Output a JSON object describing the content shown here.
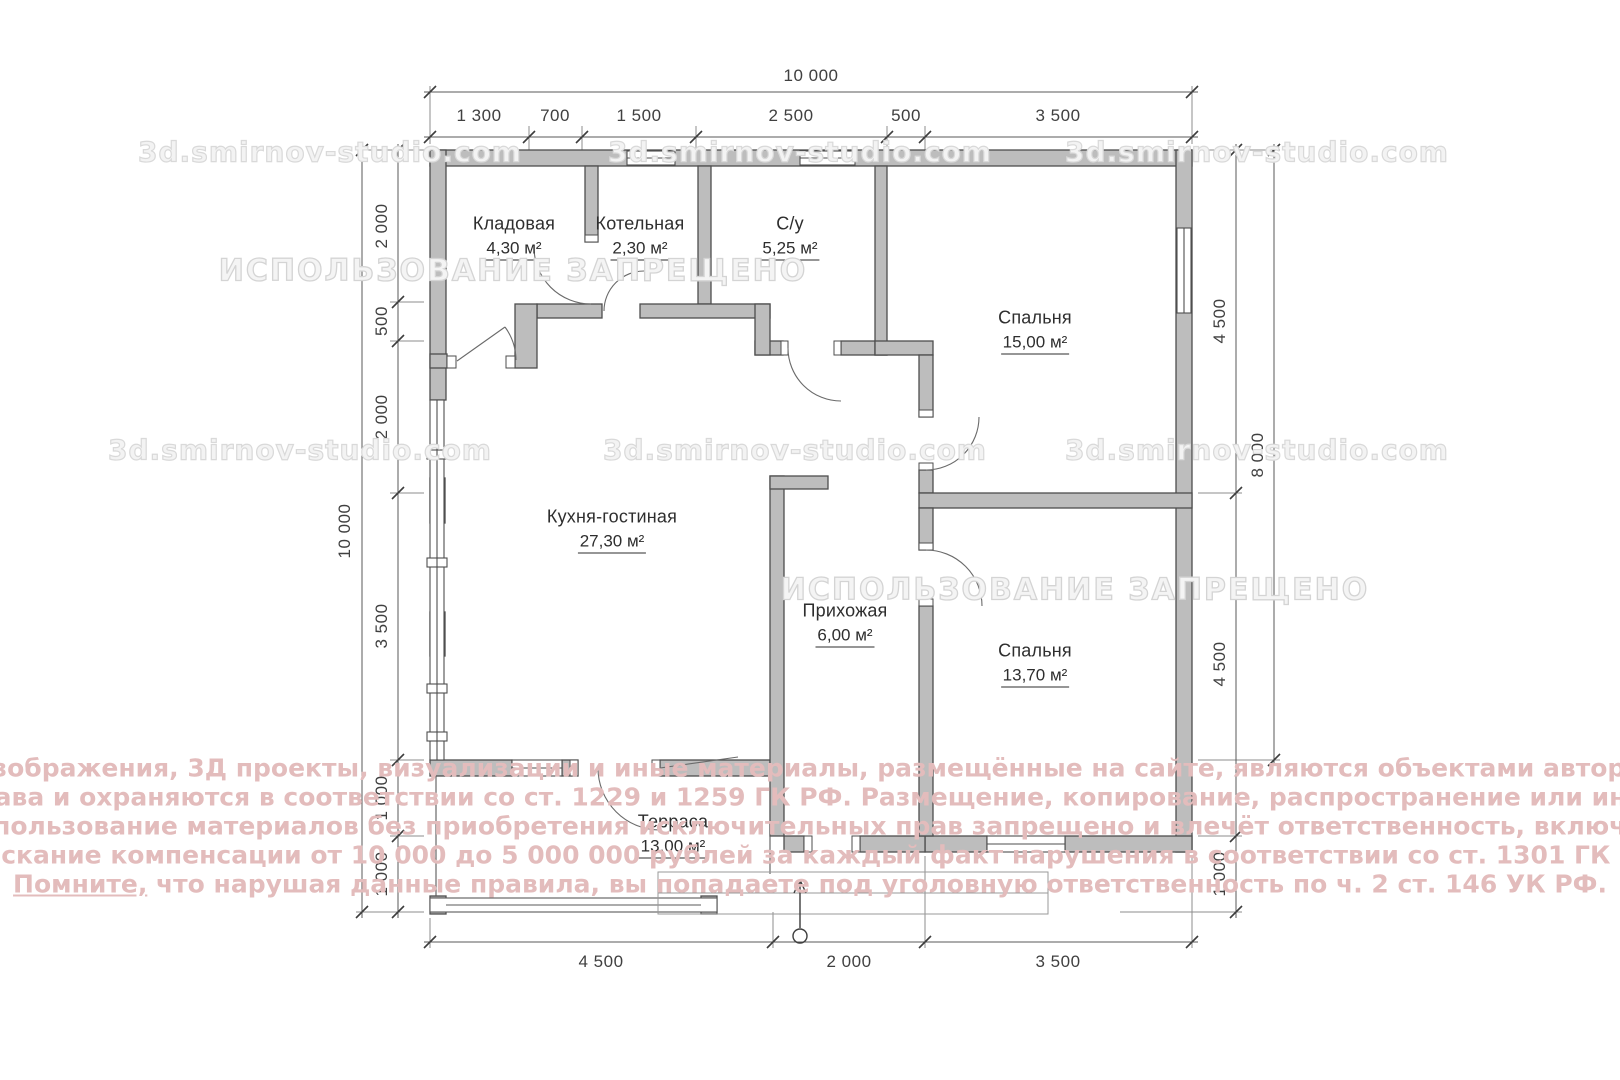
{
  "rooms": [
    {
      "name": "Кладовая",
      "area": "4,30 м²"
    },
    {
      "name": "Котельная",
      "area": "2,30 м²"
    },
    {
      "name": "С/у",
      "area": "5,25 м²"
    },
    {
      "name": "Спальня",
      "area": "15,00 м²"
    },
    {
      "name": "Кухня-гостиная",
      "area": "27,30 м²"
    },
    {
      "name": "Прихожая",
      "area": "6,00 м²"
    },
    {
      "name": "Спальня",
      "area": "13,70 м²"
    },
    {
      "name": "Терраса",
      "area": "13,00 м²"
    }
  ],
  "dimensions": {
    "top_total": "10 000",
    "top_segments": [
      "1 300",
      "700",
      "1 500",
      "2 500",
      "500",
      "3 500"
    ],
    "left_total": "10 000",
    "left_segments": [
      "2 000",
      "500",
      "2 000",
      "3 500",
      "1 000",
      "1 000"
    ],
    "right_total": "8 000",
    "right_segments": [
      "4 500",
      "4 500",
      "1 000"
    ],
    "bottom_segments": [
      "4 500",
      "2 000",
      "3 500"
    ]
  },
  "watermarks": {
    "site": "3d.smirnov-studio.com",
    "forbidden": "ИСПОЛЬЗОВАНИЕ ЗАПРЕЩЕНО"
  },
  "copyright": {
    "line1": "Все изображения, 3Д проекты, визуализации и иные материалы, размещённые на сайте, являются объектами авторского",
    "line2": "права и охраняются в соответствии со ст. 1229 и 1259 ГК РФ. Размещение, копирование, распространение или иное",
    "line3": "использование материалов без приобретения исключительных прав запрещено и влечёт ответственность, включая",
    "line4": "взыскание компенсации от 10 000 до 5 000 000 рублей за каждый факт нарушения в соответствии со ст. 1301 ГК РФ.",
    "line5_word": "Помните,",
    "line5_rest": " что нарушая данные правила, вы попадаете под уголовную ответственность по ч. 2 ст. 146 УК РФ."
  },
  "colors": {
    "wall_fill": "#bdbdbd",
    "wall_stroke": "#4e4e4e",
    "copyright_pink": "#e3bcbc",
    "watermark_gray": "#d9d9d9"
  }
}
